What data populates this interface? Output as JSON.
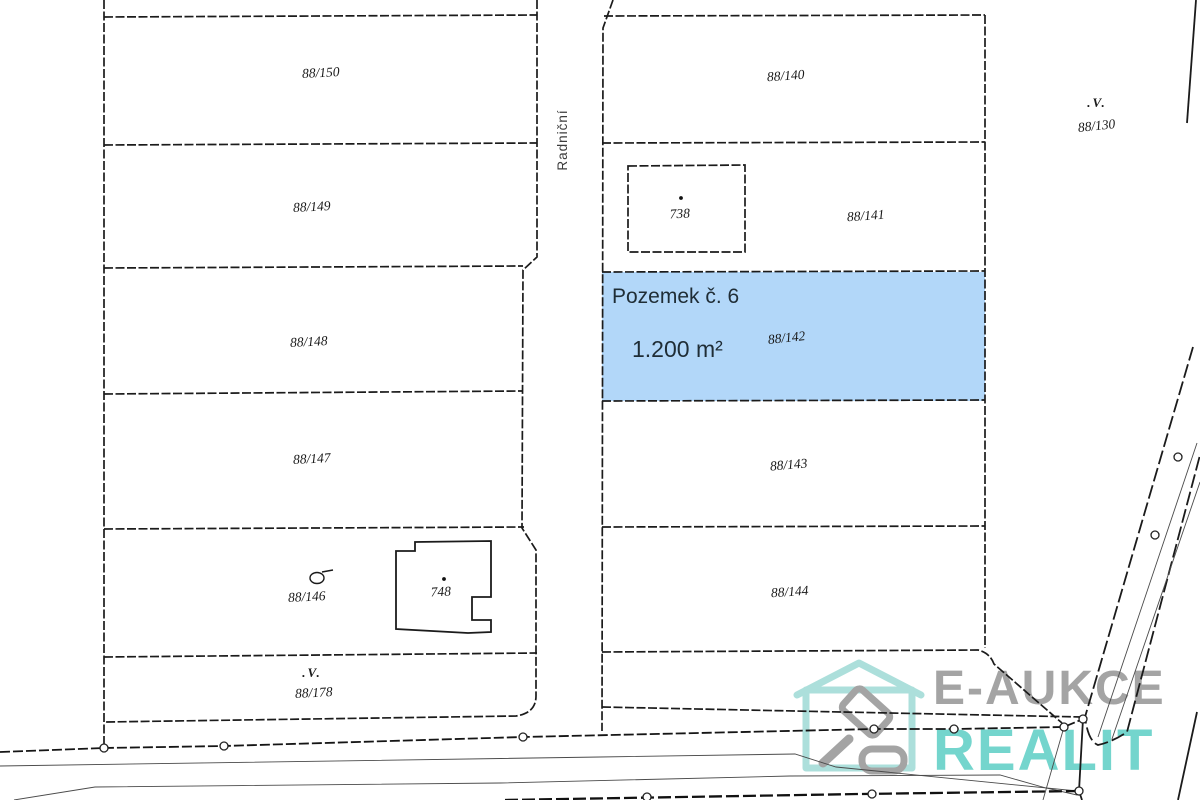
{
  "map": {
    "street": {
      "label": "Radniční"
    },
    "highlight_parcel": {
      "title": "Pozemek č. 6",
      "area": "1.200 m²",
      "parcel_number": "88/142",
      "fill_color": "#b2d7f9",
      "number_color": "#335a76"
    },
    "parcel_labels": {
      "p88_150": "88/150",
      "p88_149": "88/149",
      "p88_148": "88/148",
      "p88_147": "88/147",
      "p88_146": "88/146",
      "p88_178": "88/178",
      "p88_140": "88/140",
      "p88_141": "88/141",
      "p88_143": "88/143",
      "p88_144": "88/144",
      "p88_130": "88/130"
    },
    "building_labels": {
      "b738": "738",
      "b748": "748"
    },
    "landuse_symbol": ".V."
  },
  "watermark": {
    "line1": "E-AUKCE",
    "line2": "REALIT",
    "line1_color": "#9d9d9d",
    "line2_color": "#69d2c9",
    "house_color": "#a5ddd8",
    "gavel_color": "#9d9d9d"
  }
}
